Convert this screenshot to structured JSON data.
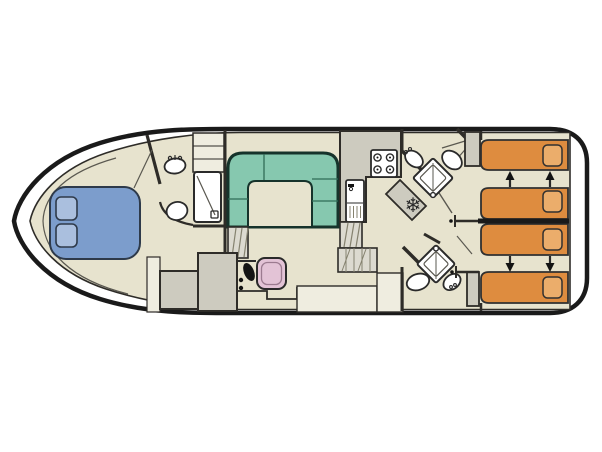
{
  "diagram": {
    "kind": "boat-floorplan",
    "areas": [
      "bow-cabin",
      "front-bathroom",
      "saloon-dinette",
      "helm-station",
      "galley",
      "aft-bathroom-top",
      "aft-bathroom-bottom",
      "aft-cabin-top",
      "aft-cabin-bottom"
    ]
  },
  "icons": {
    "fridge_snowflake": "❄"
  },
  "colors": {
    "hull_outline": "#1a1a1a",
    "deck": "#ffffff",
    "floor": "#e7e3ce",
    "wall": "#2e2c28",
    "counter": "#cdcbbf",
    "counter_light": "#efede0",
    "steps": "#dcdad0",
    "hatch": "#85826f",
    "sofa": "#86c8af",
    "sofa_outline": "#16332b",
    "cushion_line": "#2f6b56",
    "bed_blue": "#7c9dcc",
    "pillow_blue": "#aabfde",
    "blue_outline": "#2e3a4a",
    "bed_orange": "#de8c3f",
    "pillow_orange": "#ebad6b",
    "orange_outline": "#303030",
    "seat_pink": "#e3c3d6",
    "seat_pink_inner": "#9c7b90",
    "fixture": "#ffffff",
    "fixture_line": "#2a2a2a",
    "thin_line": "#5a5850",
    "arrow": "#141414"
  }
}
